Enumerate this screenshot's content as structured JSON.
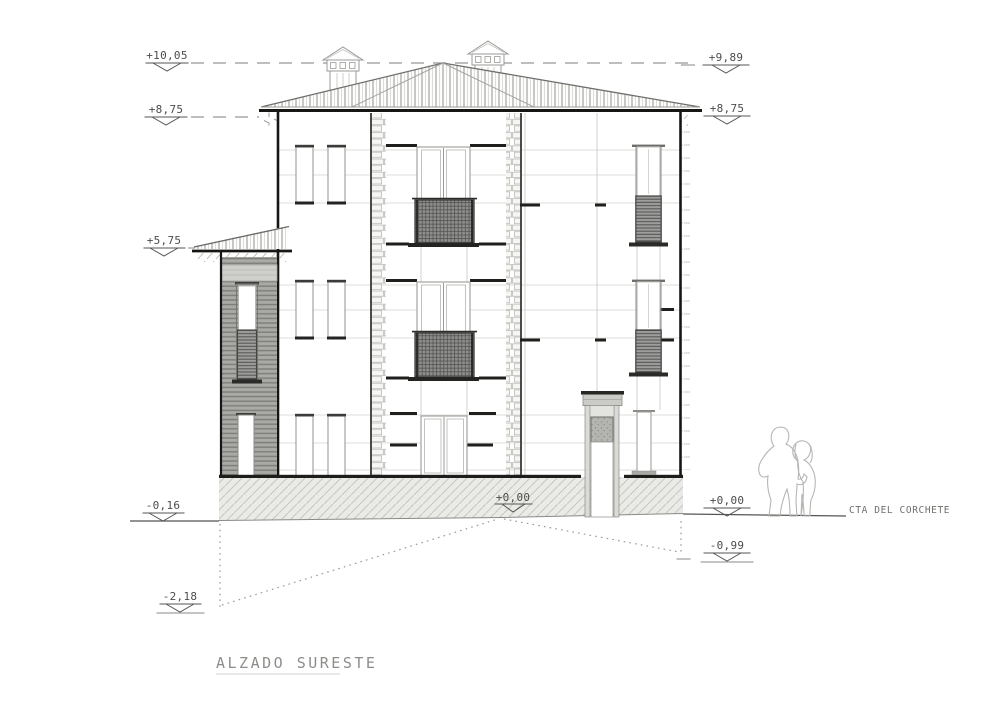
{
  "drawing": {
    "title": "ALZADO SURESTE",
    "street_label": "CTA DEL CORCHETE",
    "levels": {
      "top_left": "+10,05",
      "eave_left": "+8,75",
      "annex_roof": "+5,75",
      "ground_left": "-0,16",
      "basement": "-2,18",
      "top_right": "+9,89",
      "eave_right": "+8,75",
      "ground_center": "+0,00",
      "ground_right": "+0,00",
      "street_low": "-0,99"
    },
    "colors": {
      "paper": "#ffffff",
      "line_dark": "#1d1d1b",
      "line_mid": "#8a8a87",
      "line_light": "#d8d8d5",
      "hatch_fill": "#eaeae7",
      "siding_fill": "#a9a9a6",
      "shutter_fill": "#9d9d9b"
    }
  }
}
